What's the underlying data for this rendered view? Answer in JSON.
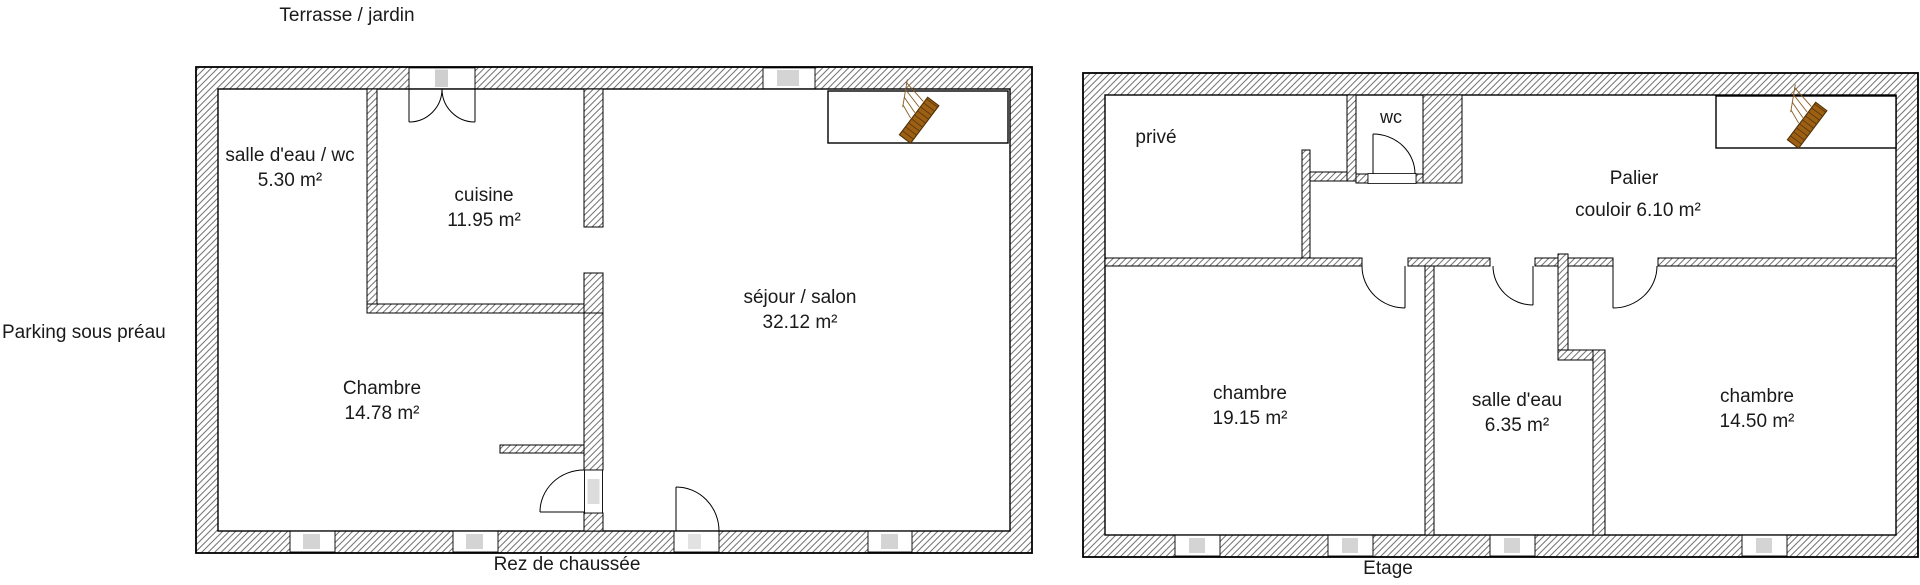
{
  "outside_labels": {
    "terrace": "Terrasse / jardin",
    "parking": "Parking sous préau"
  },
  "captions": {
    "ground_floor": "Rez de chaussée",
    "upper_floor": "Etage"
  },
  "ground_floor": {
    "rooms": [
      {
        "name": "salle d'eau / wc",
        "area": "5.30 m²"
      },
      {
        "name": "cuisine",
        "area": "11.95 m²"
      },
      {
        "name": "séjour / salon",
        "area": "32.12 m²"
      },
      {
        "name": "Chambre",
        "area": "14.78 m²"
      }
    ]
  },
  "upper_floor": {
    "rooms": [
      {
        "name": "privé",
        "area": ""
      },
      {
        "name": "wc",
        "area": ""
      },
      {
        "name": "Palier",
        "area": "couloir 6.10 m²"
      },
      {
        "name": "chambre",
        "area": "19.15 m²"
      },
      {
        "name": "salle d'eau",
        "area": "6.35 m²"
      },
      {
        "name": "chambre",
        "area": "14.50 m²"
      }
    ]
  },
  "icons": {
    "stairs": "stairs-icon"
  },
  "colors": {
    "wall_hatch_line": "#757575",
    "wall_outline": "#000000",
    "window_pane": "#d4d4d4",
    "stairs_wood": "#9c5f13",
    "stairs_wood_dark": "#4f3006",
    "text": "#1a1a1a",
    "background": "#ffffff"
  }
}
